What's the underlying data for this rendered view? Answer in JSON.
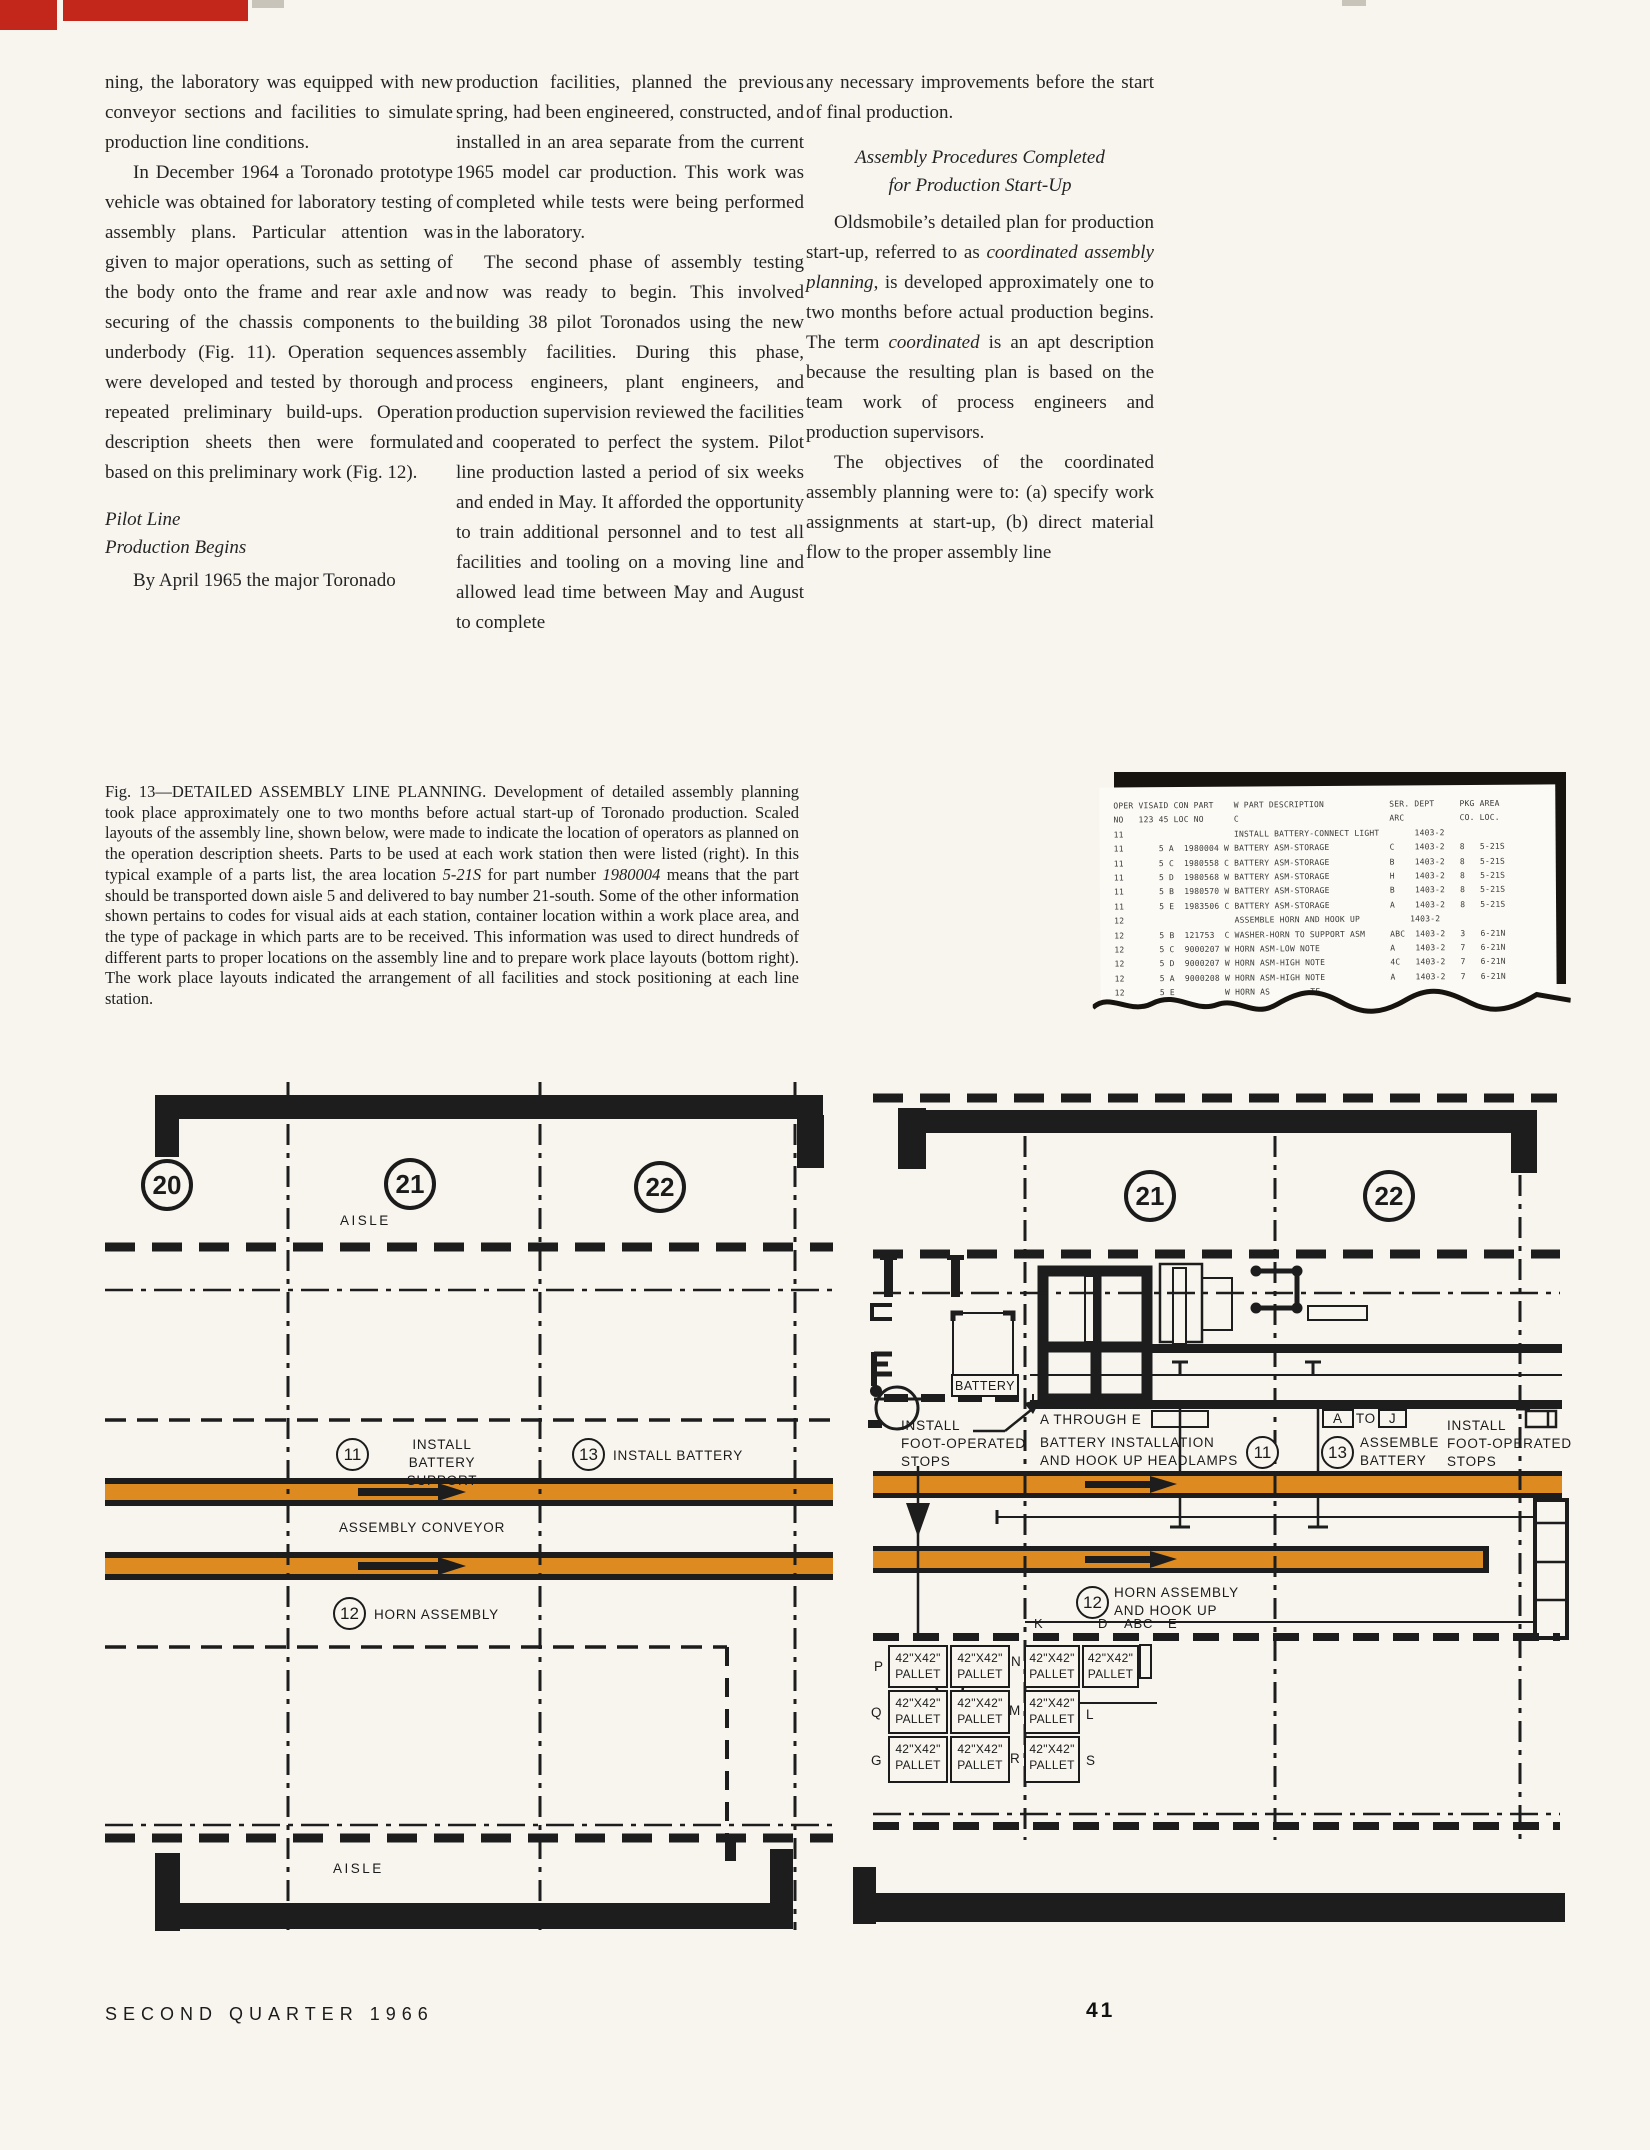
{
  "article": {
    "columns": [
      {
        "blocks": [
          {
            "kind": "para",
            "indent": false,
            "segments": [
              {
                "t": "ning, the laboratory was equipped with new conveyor sections and facilities to simulate production line conditions."
              }
            ]
          },
          {
            "kind": "para",
            "indent": true,
            "segments": [
              {
                "t": "In December 1964 a Toronado prototype vehicle was obtained for laboratory testing of assembly plans. Particular attention was given to major operations, such as setting of the body onto the frame and rear axle and securing of the chassis components to the underbody (Fig. 11). Operation sequences were developed and tested by thorough and repeated preliminary build-ups. Operation description sheets then were formulated based on this preliminary work (Fig. 12)."
              }
            ]
          },
          {
            "kind": "heading",
            "align": "left",
            "lines": [
              "Pilot Line",
              "Production Begins"
            ]
          },
          {
            "kind": "para",
            "indent": true,
            "segments": [
              {
                "t": "By April 1965 the major Toronado"
              }
            ]
          }
        ]
      },
      {
        "blocks": [
          {
            "kind": "para",
            "indent": false,
            "segments": [
              {
                "t": "production facilities, planned the previous spring, had been engineered, constructed, and installed in an area separate from the current 1965 model car production. This work was completed while tests were being performed in the laboratory."
              }
            ]
          },
          {
            "kind": "para",
            "indent": true,
            "segments": [
              {
                "t": "The second phase of assembly testing now was ready to begin. This involved building 38 pilot Toronados using the new assembly facilities. During this phase, process engineers, plant engineers, and production supervision reviewed the facilities and cooperated to perfect the system. Pilot line production lasted a period of six weeks and ended in May. It afforded the opportunity to train additional personnel and to test all facilities and tooling on a moving line and allowed lead time between May and August to complete"
              }
            ]
          }
        ]
      },
      {
        "blocks": [
          {
            "kind": "para",
            "indent": false,
            "segments": [
              {
                "t": "any necessary improvements before the start of final production."
              }
            ]
          },
          {
            "kind": "heading",
            "align": "center",
            "lines": [
              "Assembly Procedures Completed",
              "for Production Start-Up"
            ]
          },
          {
            "kind": "para",
            "indent": true,
            "segments": [
              {
                "t": "Oldsmobile’s detailed plan for production start-up, referred to as "
              },
              {
                "t": "coordinated assembly planning",
                "i": true
              },
              {
                "t": ", is developed approximately one to two months before actual production begins. The term "
              },
              {
                "t": "coordinated",
                "i": true
              },
              {
                "t": " is an apt description because the resulting plan is based on the team work of process engineers and production supervisors."
              }
            ]
          },
          {
            "kind": "para",
            "indent": true,
            "segments": [
              {
                "t": "The objectives of the coordinated assembly planning were to: (a) specify work assignments at start-up, (b) direct material flow to the proper assembly line"
              }
            ]
          }
        ]
      }
    ]
  },
  "caption": {
    "segments": [
      {
        "t": "Fig. 13—DETAILED ASSEMBLY LINE PLANNING. Development of detailed assembly planning took place approximately one to two months before actual start-up of Toronado production. Scaled layouts of the assembly line, shown below, were made to indicate the location of operators as planned on the operation description sheets. Parts to be used at each work station then were listed (right). In this typical example of a parts list, the area location "
      },
      {
        "t": "5-21S",
        "i": true
      },
      {
        "t": " for part number "
      },
      {
        "t": "1980004",
        "i": true
      },
      {
        "t": " means that the part should be transported down aisle 5 and delivered to bay number 21-south. Some of the other information shown pertains to codes for visual aids at each station, container location within a work place area, and the type of package in which parts are to be received. This information was used to direct hundreds of different parts to proper locations on the assembly line and to prepare work place layouts (bottom right). The work place layouts indicated the arrangement of all facilities and stock positioning at each line station."
      }
    ]
  },
  "printout": {
    "lines": [
      "OPER VISAID CON PART    W PART DESCRIPTION             SER. DEPT     PKG AREA",
      "NO   123 45 LOC NO      C                              ARC           CO. LOC.",
      "11                      INSTALL BATTERY-CONNECT LIGHT       1403-2",
      "11       5 A  1980004 W BATTERY ASM-STORAGE            C    1403-2   8   5-21S",
      "11       5 C  1980558 C BATTERY ASM-STORAGE            B    1403-2   8   5-21S",
      "11       5 D  1980568 W BATTERY ASM-STORAGE            H    1403-2   8   5-21S",
      "11       5 B  1980570 W BATTERY ASM-STORAGE            B    1403-2   8   5-21S",
      "11       5 E  1983506 C BATTERY ASM-STORAGE            A    1403-2   8   5-21S",
      "12                      ASSEMBLE HORN AND HOOK UP          1403-2",
      "12       5 B  121753  C WASHER-HORN TO SUPPORT ASM     ABC  1403-2   3   6-21N",
      "12       5 C  9000207 W HORN ASM-LOW NOTE              A    1403-2   7   6-21N",
      "12       5 D  9000207 W HORN ASM-HIGH NOTE             4C   1403-2   7   6-21N",
      "12       5 A  9000208 W HORN ASM-HIGH NOTE             A    1403-2   7   6-21N",
      "12       5 E          W HORN AS        TE"
    ]
  },
  "left_plan": {
    "stations": {
      "s20": "20",
      "s21": "21",
      "s22": "22"
    },
    "aisle_top": "AISLE",
    "aisle_bottom": "AISLE",
    "op11": {
      "num": "11",
      "l1": "INSTALL BATTERY",
      "l2": "SUPPORT"
    },
    "op13": {
      "num": "13",
      "label": "INSTALL BATTERY"
    },
    "conveyor_label": "ASSEMBLY CONVEYOR",
    "op12": {
      "num": "12",
      "label": "HORN ASSEMBLY"
    }
  },
  "right_plan": {
    "stations": {
      "s21": "21",
      "s22": "22"
    },
    "battery_box": "BATTERY",
    "stops_left": {
      "l1": "INSTALL",
      "l2": "FOOT-OPERATED",
      "l3": "STOPS"
    },
    "a_through_e": "A THROUGH E",
    "batt_install": {
      "num": "11",
      "l1": "BATTERY  INSTALLATION",
      "l2": "AND  HOOK  UP  HEADLAMPS"
    },
    "a_to_j": {
      "a": "A",
      "to": "TO",
      "j": "J"
    },
    "assemble": {
      "num": "13",
      "l1": "ASSEMBLE",
      "l2": "BATTERY"
    },
    "stops_right": {
      "l1": "INSTALL",
      "l2": "FOOT-OPERATED",
      "l3": "STOPS"
    },
    "horn": {
      "num": "12",
      "l1": "HORN  ASSEMBLY",
      "l2": "AND  HOOK  UP"
    },
    "positions": {
      "k": "K",
      "d": "D",
      "abc": "ABC",
      "e": "E"
    },
    "row_labels": {
      "r1": "P",
      "r2": "Q",
      "r3": "G"
    },
    "mid_labels": {
      "r1": "N",
      "r2": "M",
      "r3": "R"
    },
    "side_labels": {
      "r2": "L",
      "r3": "S"
    },
    "pallet": {
      "size": "42\"X42\"",
      "word": "PALLET"
    },
    "pallet_cells": [
      {
        "x": 888,
        "y": 1645,
        "w": 60,
        "h": 43
      },
      {
        "x": 950,
        "y": 1645,
        "w": 60,
        "h": 43
      },
      {
        "x": 1024,
        "y": 1645,
        "w": 56,
        "h": 43
      },
      {
        "x": 1082,
        "y": 1645,
        "w": 57,
        "h": 43
      },
      {
        "x": 888,
        "y": 1690,
        "w": 60,
        "h": 44
      },
      {
        "x": 950,
        "y": 1690,
        "w": 60,
        "h": 44
      },
      {
        "x": 1024,
        "y": 1690,
        "w": 56,
        "h": 44
      },
      {
        "x": 888,
        "y": 1736,
        "w": 60,
        "h": 47
      },
      {
        "x": 950,
        "y": 1736,
        "w": 60,
        "h": 47
      },
      {
        "x": 1024,
        "y": 1736,
        "w": 56,
        "h": 47
      }
    ]
  },
  "footer": {
    "left": "SECOND QUARTER 1966",
    "page_number": "41"
  },
  "colors": {
    "accent_orange": "#dd8a21",
    "ink": "#1b1b1b",
    "paper": "#f8f5ef",
    "red_mark": "#c3271b"
  }
}
